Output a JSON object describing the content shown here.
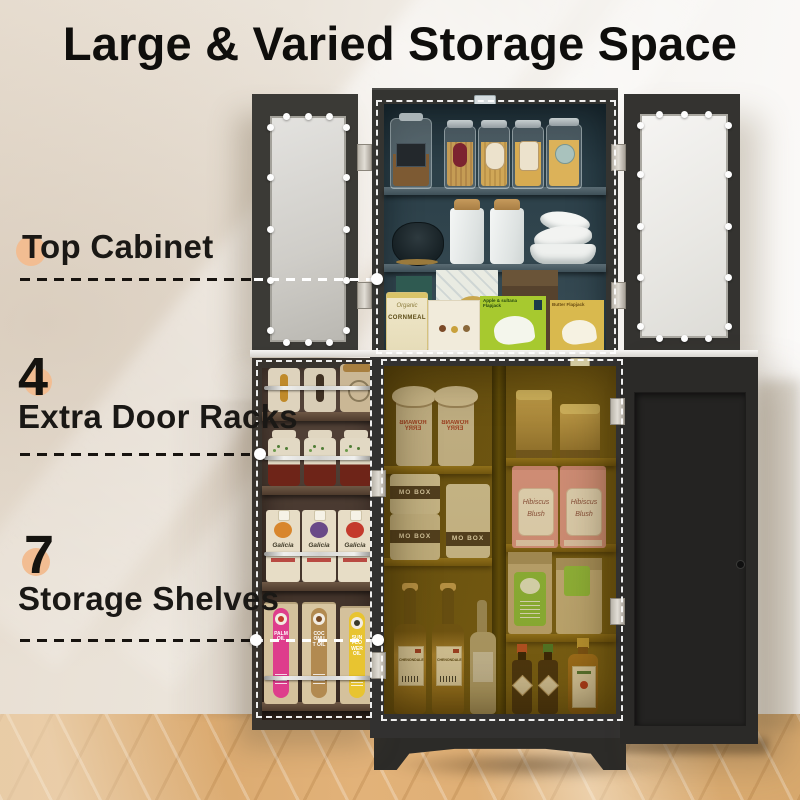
{
  "title": "Large & Varied Storage Space",
  "callouts": {
    "top_cabinet": {
      "label": "Top Cabinet"
    },
    "door_racks": {
      "number": "4",
      "label": "Extra Door Racks"
    },
    "shelves": {
      "number": "7",
      "label": "Storage Shelves"
    }
  },
  "products": {
    "cornmeal_brand": "Organic",
    "cornmeal": "CORNMEAL",
    "flapjack_green": "Apple & sultana Flapjack",
    "flapjack_yellow": "Butter Flapjack",
    "rowanberry": "ROWANBERRY",
    "mo_box": "MO BOX",
    "hibiscus_line1": "Hibiscus",
    "hibiscus_line2": "Blush",
    "wine": "CHENONDALE",
    "galicia": "Galicia",
    "palm_oil": "PALM OIL",
    "coconut_oil": "COCONUT OIL",
    "sunflower_oil": "SUN FLOWER OIL"
  },
  "colors": {
    "accent_peach": "#f2bd92",
    "leader_dash": "#17130f",
    "highlight_dash": "#ffffff",
    "cabinet_frame": "#343431",
    "top_interior_teal": "#2b3f48",
    "lower_interior_amber": "#6b5413",
    "floor_wood": "#d8a96e"
  }
}
